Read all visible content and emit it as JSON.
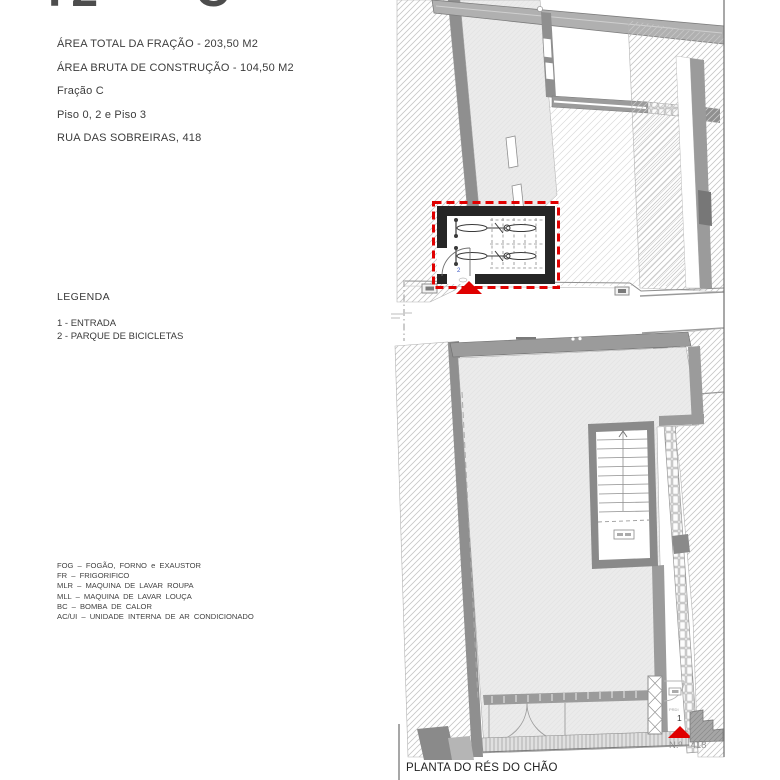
{
  "header": {
    "title_left": "T2",
    "title_right": "C"
  },
  "info": {
    "lines": [
      "ÁREA TOTAL DA FRAÇÃO - 203,50 M2",
      "ÁREA BRUTA DE CONSTRUÇÃO - 104,50 M2",
      "Fração C",
      "Piso 0, 2 e Piso 3",
      "RUA DAS SOBREIRAS, 418"
    ]
  },
  "legend": {
    "title": "LEGENDA",
    "items": [
      "1 - ENTRADA",
      "2 - PARQUE DE BICICLETAS"
    ]
  },
  "abbreviations": [
    "FOG – FOGÃO, FORNO e EXAUSTOR",
    "FR – FRIGORIFICO",
    "MLR – MAQUINA DE LAVAR ROUPA",
    "MLL – MAQUINA DE LAVAR LOUÇA",
    "BC – BOMBA DE CALOR",
    "AC/UI – UNIDADE INTERNA DE AR CONDICIONADO"
  ],
  "plan": {
    "title": "PLANTA DO RÉS DO CHÃO",
    "street_number_label": "N.º 418",
    "markers": {
      "entrance": "1",
      "bike_park": "2"
    },
    "door_tag": "PRDI"
  },
  "colors": {
    "marker_red": "#e00000",
    "marker_blue": "#3a56c4",
    "wall_dark": "#262626",
    "wall_gray": "#9b9b9b"
  }
}
